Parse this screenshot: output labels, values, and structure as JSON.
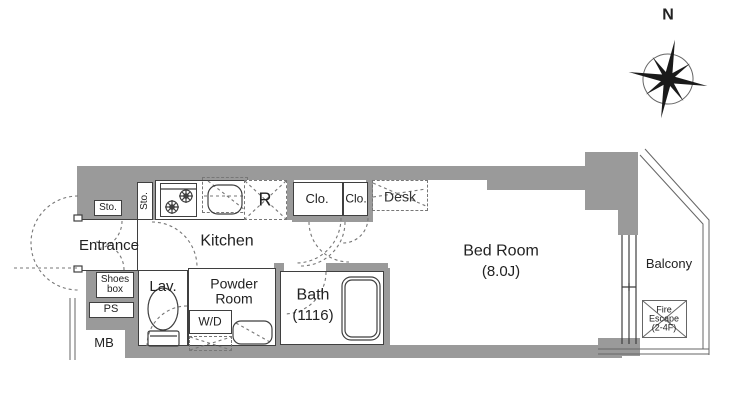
{
  "plan": {
    "compass": {
      "north_label": "N"
    },
    "labels": {
      "entrance": "Entrance",
      "sto_upper": "Sto.",
      "sto_side": "Sto.",
      "kitchen": "Kitchen",
      "fridge": "R",
      "closet1": "Clo.",
      "closet2": "Clo.",
      "desk": "Desk",
      "bedroom_name": "Bed Room",
      "bedroom_size": "(8.0J)",
      "balcony": "Balcony",
      "fire_escape_line1": "Fire",
      "fire_escape_line2": "Escape",
      "fire_escape_line3": "(2-4F)",
      "shoes_line1": "Shoes",
      "shoes_line2": "box",
      "ps": "PS",
      "mb": "MB",
      "lavatory": "Lav.",
      "powder_line1": "Powder",
      "powder_line2": "Room",
      "washer_dryer": "W/D",
      "bath_name": "Bath",
      "bath_size": "(1116)"
    },
    "colors": {
      "wall": "#9a9a9a",
      "line": "#3f3f3f",
      "dash": "#777777",
      "bg": "#ffffff"
    }
  }
}
